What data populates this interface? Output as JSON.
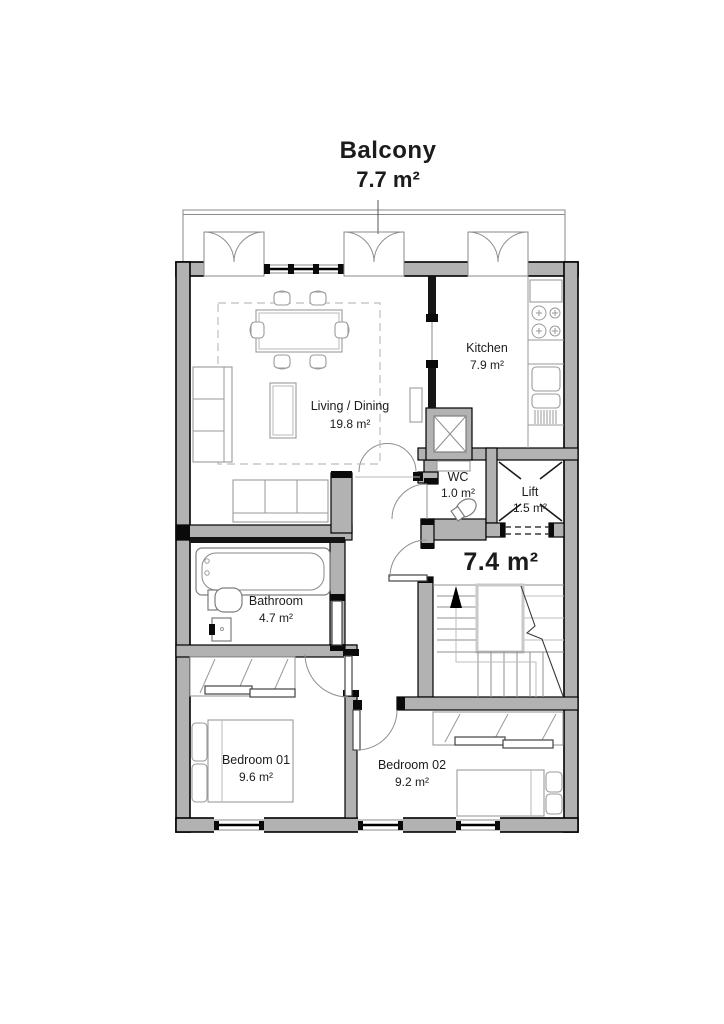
{
  "plan": {
    "balcony": {
      "name": "Balcony",
      "area": "7.7 m²"
    },
    "rooms": {
      "living": {
        "name": "Living / Dining",
        "area": "19.8 m²"
      },
      "kitchen": {
        "name": "Kitchen",
        "area": "7.9 m²"
      },
      "wc": {
        "name": "WC",
        "area": "1.0 m²"
      },
      "lift": {
        "name": "Lift",
        "area": "1.5 m²"
      },
      "hall": {
        "area": "7.4 m²"
      },
      "bathroom": {
        "name": "Bathroom",
        "area": "4.7 m²"
      },
      "bedroom1": {
        "name": "Bedroom 01",
        "area": "9.6 m²"
      },
      "bedroom2": {
        "name": "Bedroom 02",
        "area": "9.2 m²"
      }
    },
    "colors": {
      "wall_fill": "#b2b2b2",
      "partition": "#141414",
      "outline": "#000000",
      "furniture": "#9a9a9a",
      "text": "#1b1b1b"
    }
  }
}
